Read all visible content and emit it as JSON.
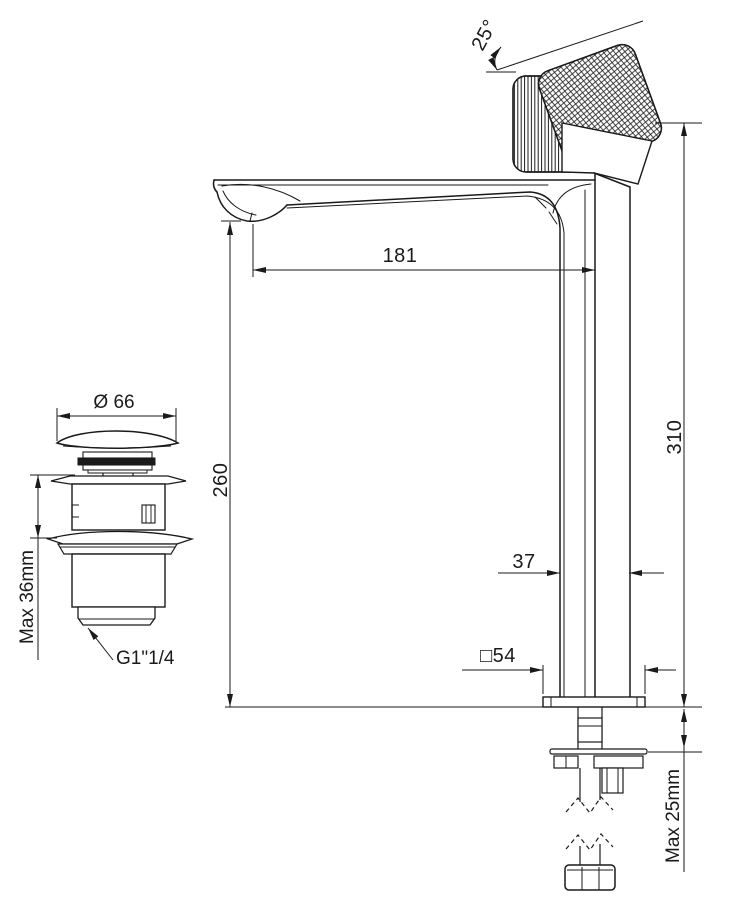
{
  "labels": {
    "angle": "25°",
    "reach": "181",
    "spout_height": "260",
    "total_height": "310",
    "body_width": "37",
    "base_square": "□54",
    "deck_max": "Max 25mm",
    "drain_diameter": "Ø 66",
    "drain_deck_max": "Max 36mm",
    "drain_thread": "G1\"1/4"
  },
  "colors": {
    "line": "#1a1a1a",
    "background": "#ffffff"
  }
}
